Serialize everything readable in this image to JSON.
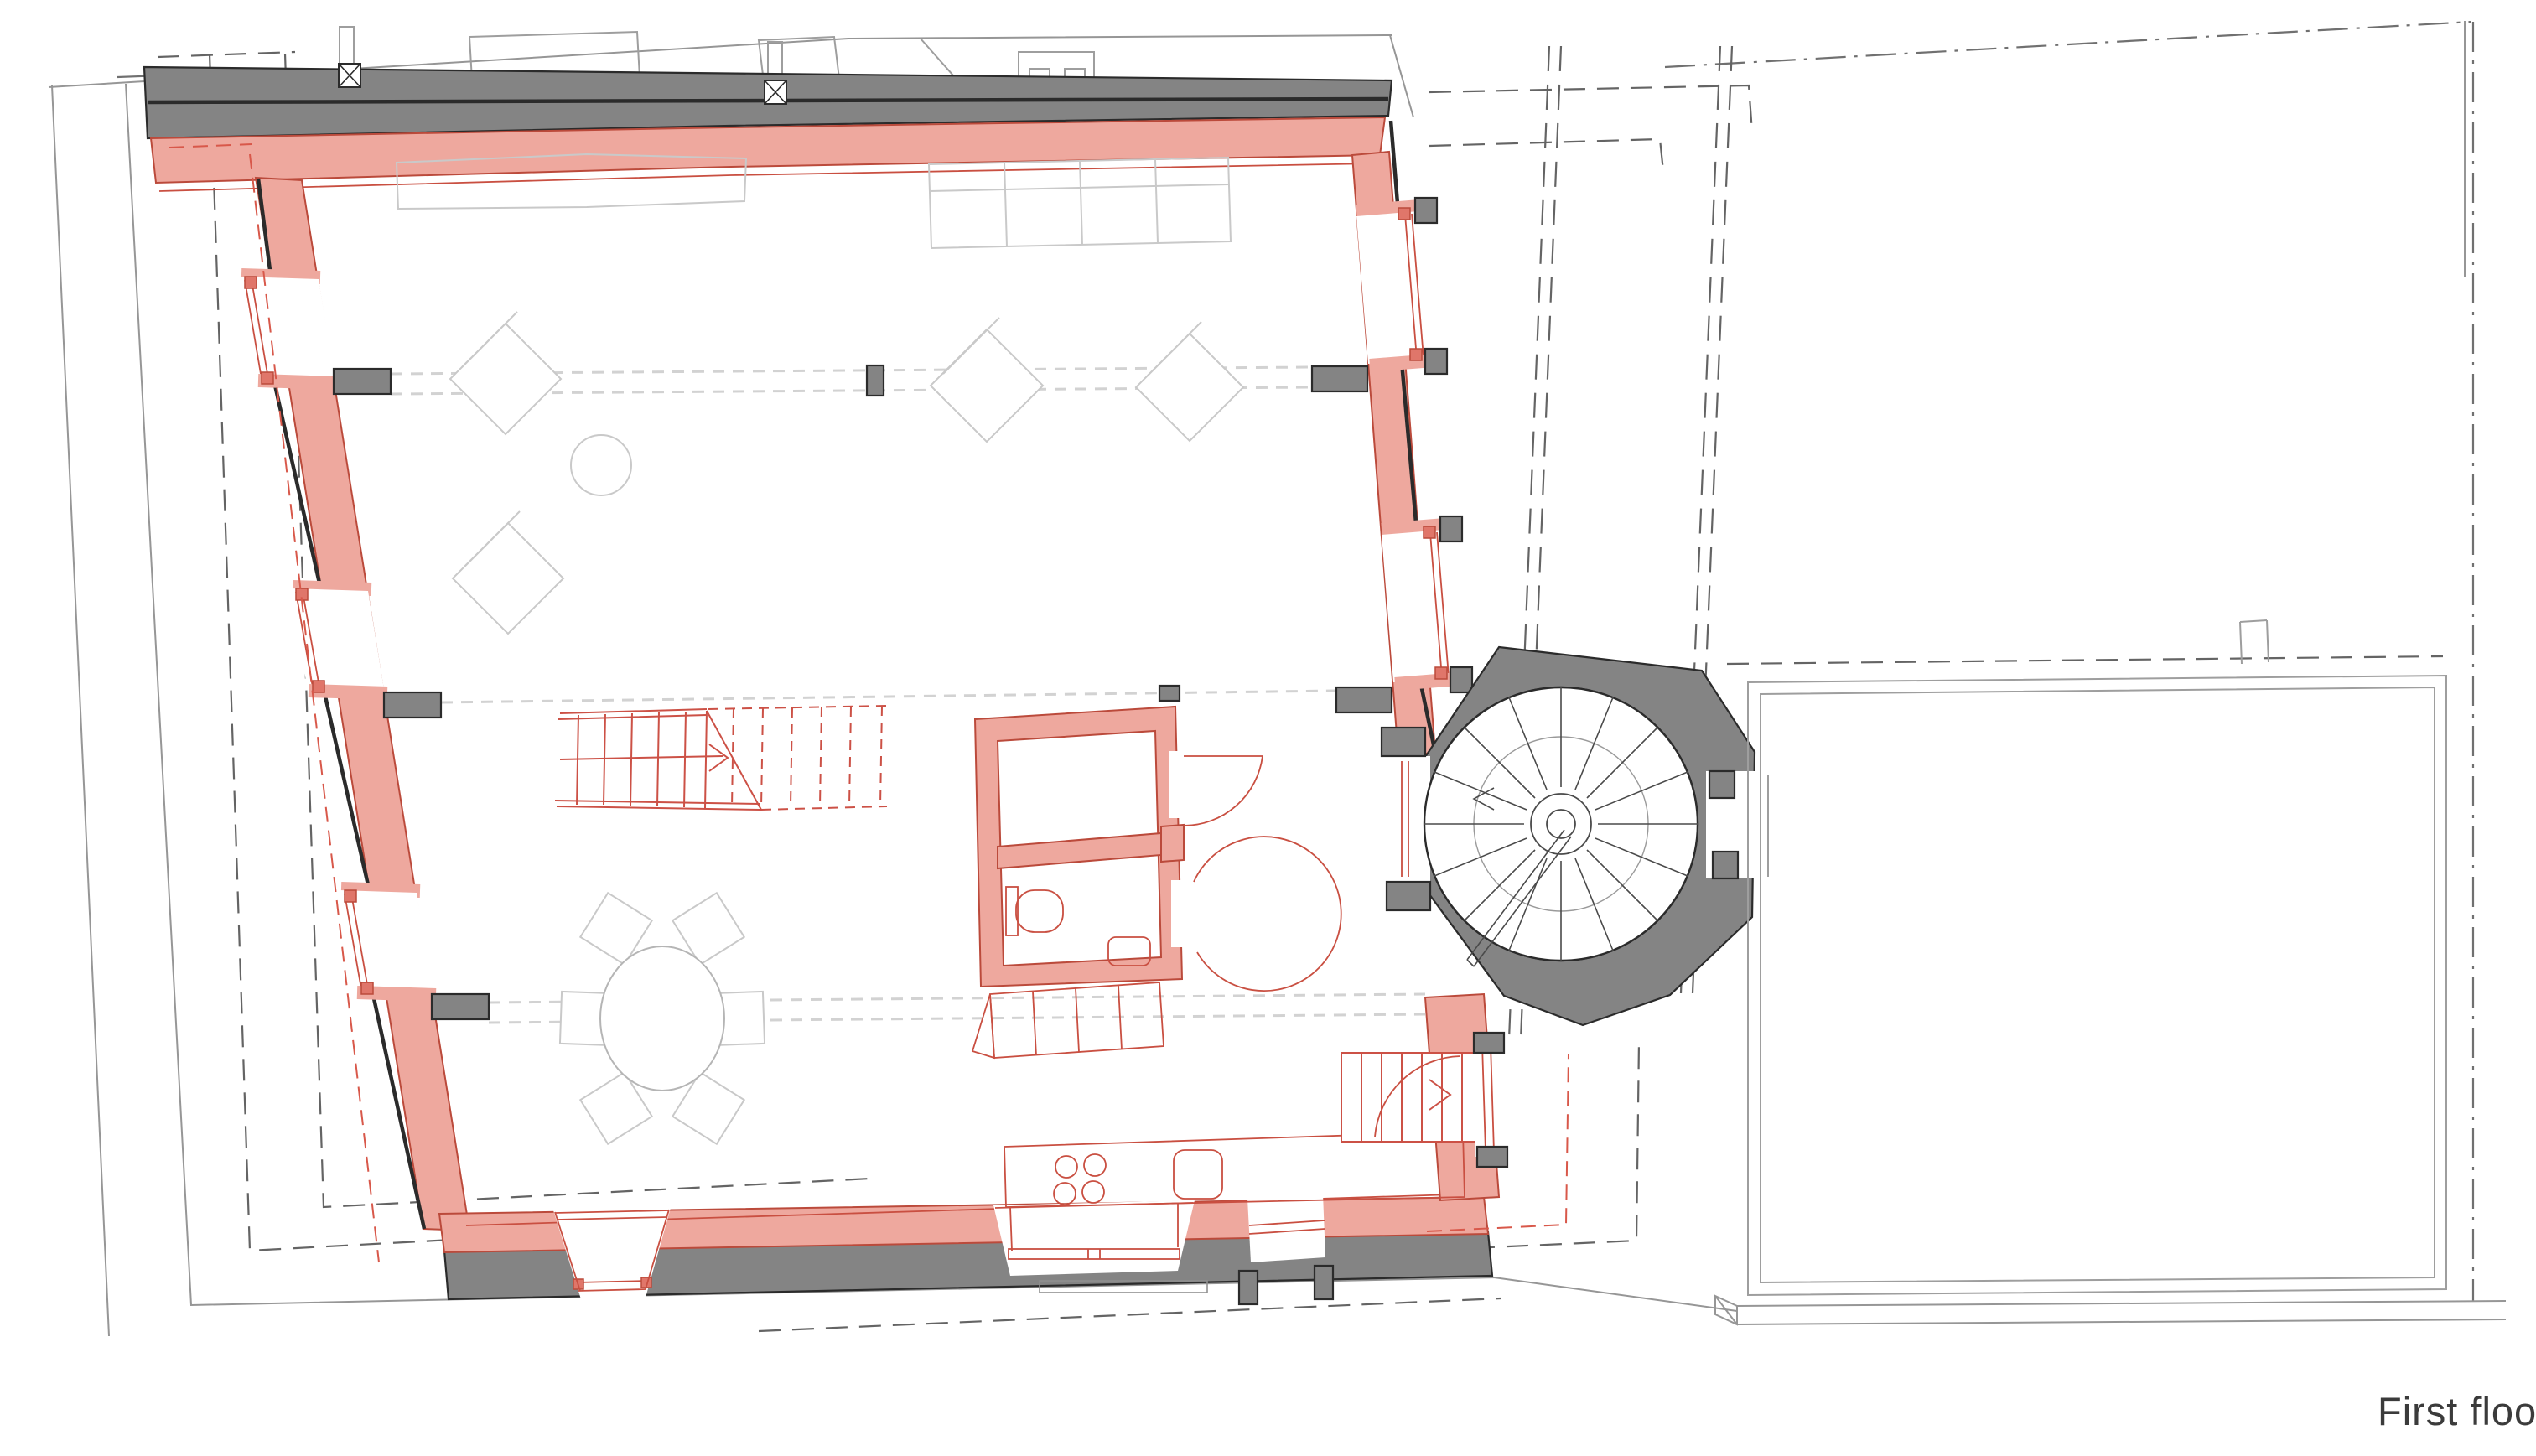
{
  "title": {
    "label": "First floor"
  },
  "colors": {
    "existing-wall": "#848484",
    "existing-wall-line": "#2b2b2b",
    "new-wall": "#eea89e",
    "new-wall-line": "#bb4a3b",
    "new-wall-accent": "#e0766a",
    "red-line": "#c94f41",
    "red-dash": "#d8584a",
    "furniture-line": "#c9c9c9",
    "table-line": "#b5b5b5",
    "site-line": "#969696",
    "neighbor-line": "#9e9e9e",
    "dark-dash": "#646464",
    "dashdot": "#707070",
    "beam-dash": "#d2d2d2",
    "stair-line": "#cc5146",
    "label-text": "#3b3b3b"
  }
}
